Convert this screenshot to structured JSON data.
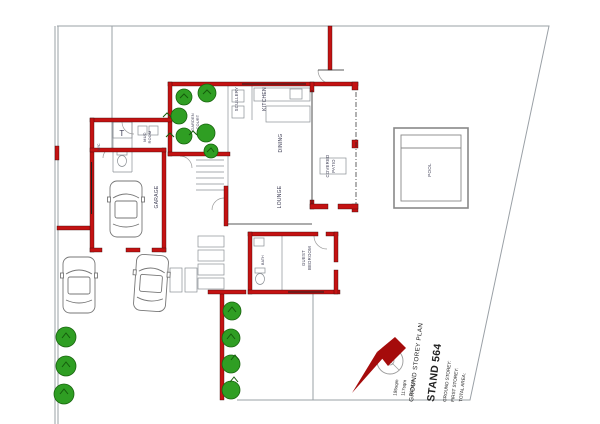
{
  "drawing": {
    "plan_title": "GROUND STOREY PLAN",
    "stand_label": "STAND 564",
    "areas": [
      {
        "label": "GROUND STOREY:",
        "value": "195sqm"
      },
      {
        "label": "FIRST STOREY:",
        "value": "117sqm"
      },
      {
        "label": "TOTAL AREA:",
        "value": "312sqm"
      }
    ],
    "rooms": {
      "garage": "GARAGE",
      "lounge": "LOUNGE",
      "dining": "DINING",
      "kitchen": "KITCHEN",
      "scullery": "SCULLERY",
      "covered_patio_1": "COVERED",
      "covered_patio_2": "PATIO",
      "pool": "POOL",
      "guest_1": "GUEST",
      "guest_2": "BEDROOM",
      "mud_1": "MUD",
      "mud_2": "ROOM",
      "court_1": "GARDEN",
      "court_2": "COURT",
      "wc": "W/C",
      "bath": "BATH",
      "geyser": "T"
    },
    "colors": {
      "wall_red": "#c41212",
      "tree_green": "#2f9e23",
      "tree_dark": "#19640f",
      "boundary_gray": "#9aa0a6",
      "label_color": "#3b3b52",
      "north_red": "#a50b0b"
    }
  }
}
